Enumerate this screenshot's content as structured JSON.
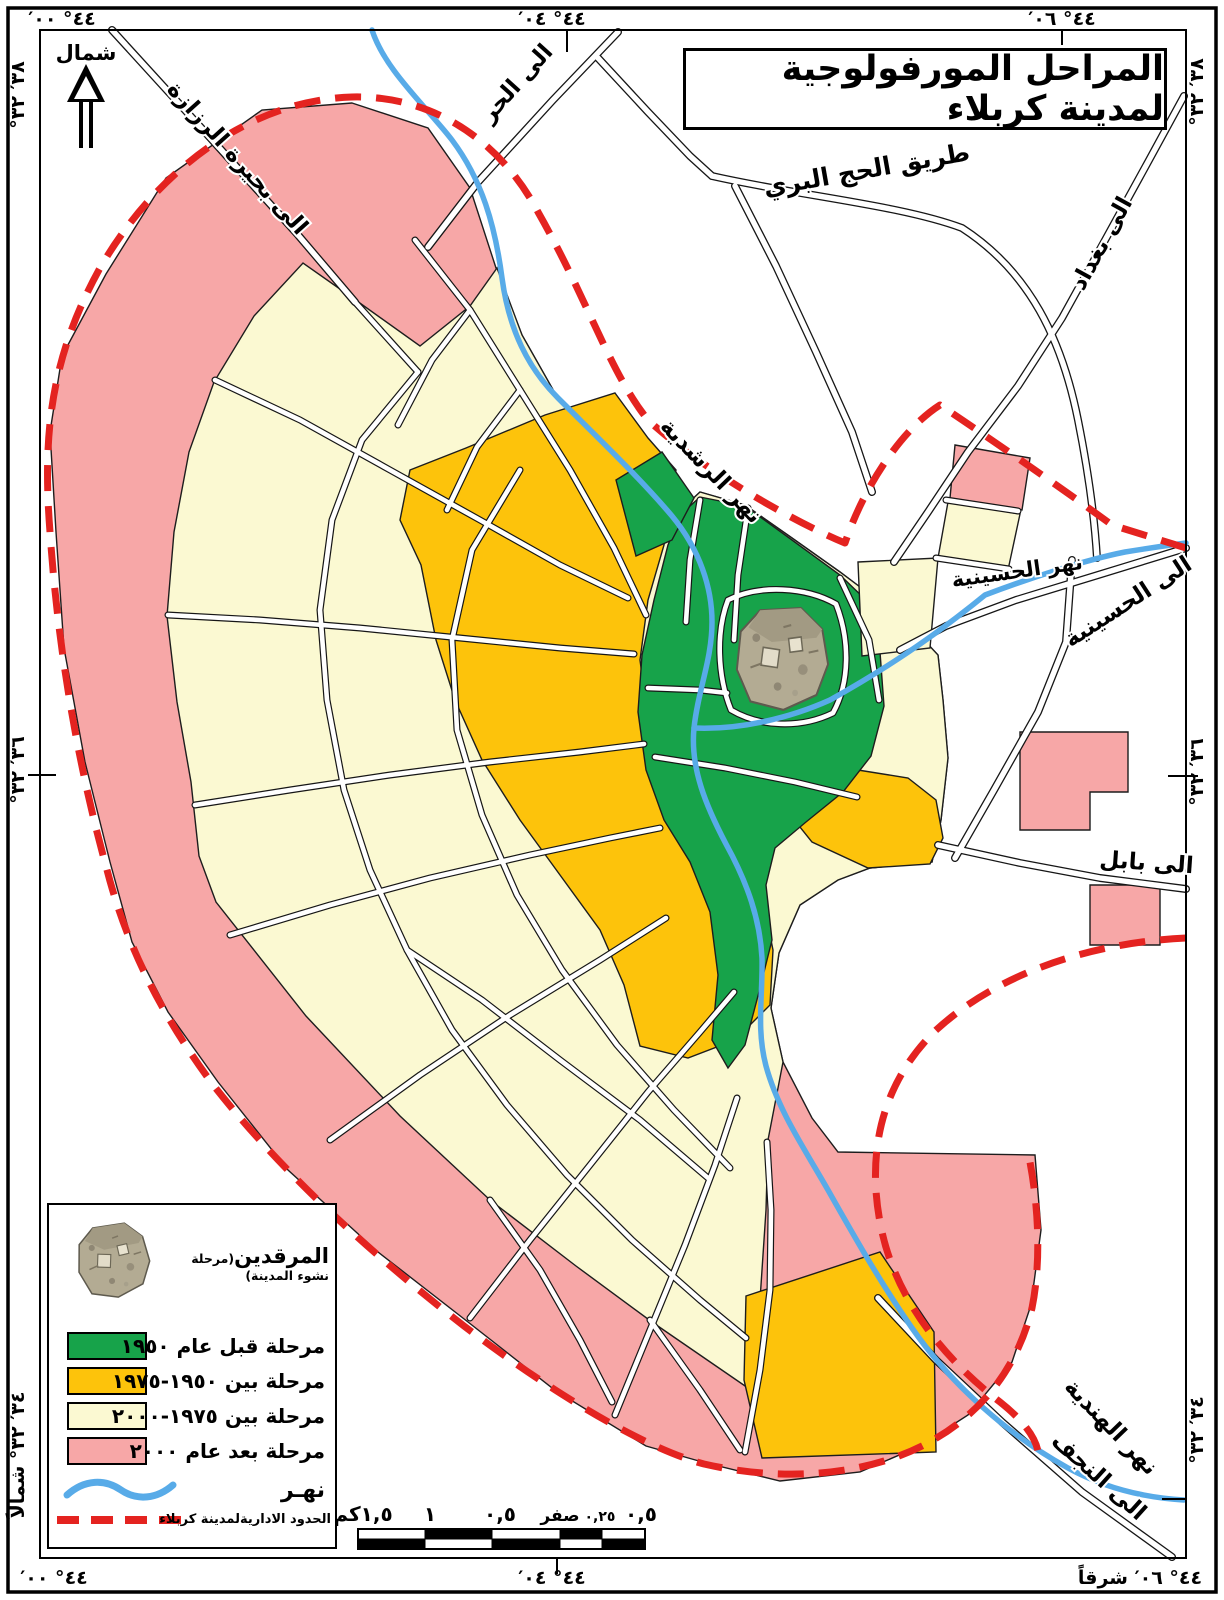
{
  "title": "المراحل المورفولوجية لمدينة كربلاء",
  "compass_label": "شمال",
  "frame_coordinates": {
    "top_left": "٤٤° ٠٠′",
    "top_center": "٤٤° ٠٤′",
    "top_right": "٤٤° ٠٦′",
    "bottom_left": "٤٤° ٠٠′",
    "bottom_center": "٤٤° ٠٤′",
    "bottom_right": "٤٤° ٠٦′ شرقاً",
    "left_top": "٣٨′ ٣٢°",
    "left_middle": "٣٦′ ٣٢°",
    "left_bottom": "٣٤′ ٣٢° شمالاً",
    "right_top": "٣٨′ ٣٢°",
    "right_middle": "٣٦′ ٣٢°",
    "right_bottom": "٣٤′ ٣٢°"
  },
  "map_labels": {
    "razzaza": "الى بحيرة الرزازة",
    "hurr": "الى الحر",
    "hajj_road": "طريق الحج البري",
    "baghdad": "الى بغداد",
    "rashdiya_river": "نهر الرشدية",
    "husseiniya_river": "نهر الحسينية",
    "husseiniya": "الى الحسينية",
    "babylon": "الى بابل",
    "hindiya_river": "نهر الهندية",
    "najaf": "الى النجف"
  },
  "legend": {
    "shrine_title": "المرقدين",
    "shrine_subtitle": "(مرحلة نشوء المدينة)",
    "items": [
      {
        "color": "#17A34A",
        "label": "مرحلة قبل عام ١٩٥٠"
      },
      {
        "color": "#FDC30B",
        "label": "مرحلة بين ١٩٥٠-١٩٧٥"
      },
      {
        "color": "#FBF9D2",
        "label": "مرحلة بين ١٩٧٥-٢٠٠٠"
      },
      {
        "color": "#F7A7A7",
        "label": "مرحلة بعد عام ٢٠٠٠"
      }
    ],
    "river_label": "نهـر",
    "boundary_label": "الحدود الاداريةلمدينة كربلاء"
  },
  "scale_bar": {
    "labels": [
      "١,٥كم",
      "١",
      "٠,٥",
      "صفر",
      "٠,٢٥",
      "٠,٥"
    ]
  },
  "colors": {
    "stage_pre_1950": "#17A34A",
    "stage_1950_1975": "#FDC30B",
    "stage_1975_2000": "#FBF9D2",
    "stage_post_2000": "#F7A7A7",
    "river": "#58ABE8",
    "admin_boundary": "#E42320"
  }
}
